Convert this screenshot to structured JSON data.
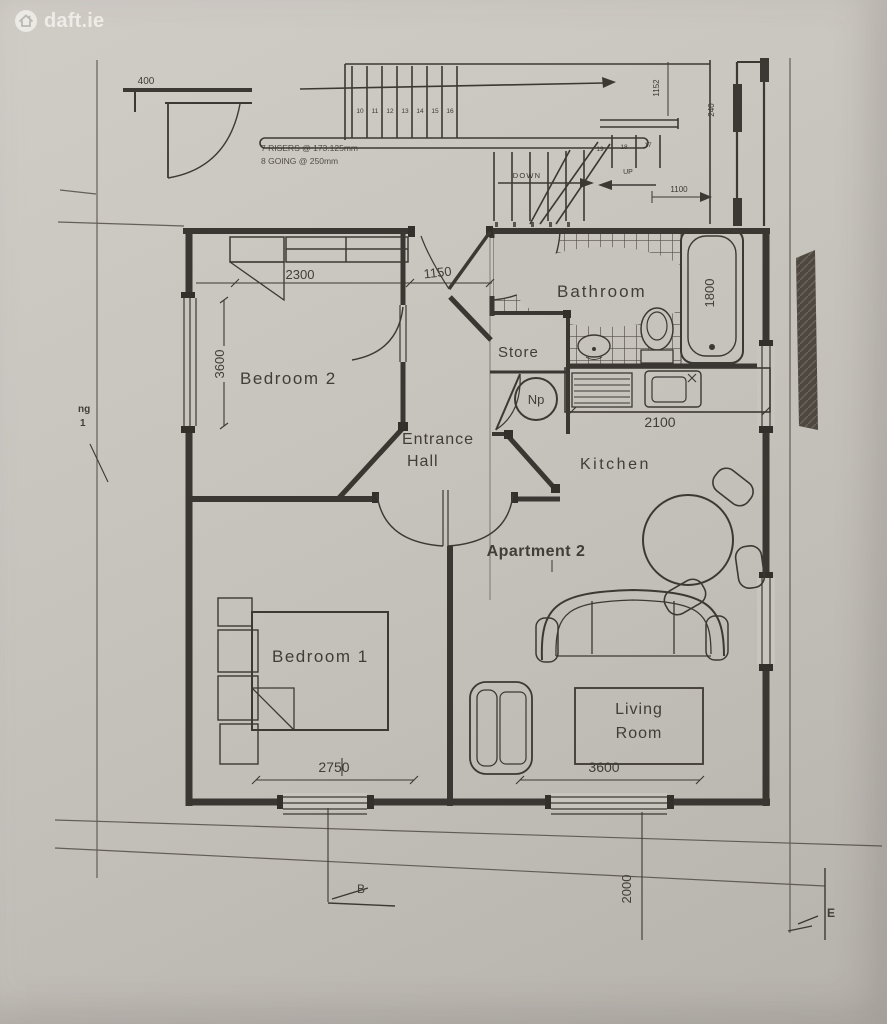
{
  "source": {
    "watermark": "daft.ie"
  },
  "plan": {
    "apartment_label": "Apartment 2",
    "rooms": {
      "bedroom2": "Bedroom 2",
      "bedroom1": "Bedroom 1",
      "entrance_line1": "Entrance",
      "entrance_line2": "Hall",
      "store": "Store",
      "bathroom": "Bathroom",
      "kitchen": "Kitchen",
      "living_line1": "Living",
      "living_line2": "Room",
      "hot_press": "Np"
    },
    "dimensions_mm": {
      "bedroom2_width": "2300",
      "hall_width": "1150",
      "bedroom2_depth": "3600",
      "bath_length": "1800",
      "kitchen_counter": "2100",
      "bedroom1_width": "2750",
      "living_width": "3600",
      "ground_offset": "2000",
      "stairwell": "1100",
      "landing": "1152",
      "wall_return": "240",
      "entry_wall": "400"
    },
    "stairs": {
      "riser_note": "7 RISERS @ 173.125mm",
      "going_note": "8 GOING @ 250mm",
      "down_label": "DOWN",
      "up_label": "UP",
      "upper_treads": [
        "10",
        "11",
        "12",
        "13",
        "14",
        "15",
        "16"
      ],
      "return_treads": [
        "19",
        "18",
        "17"
      ]
    },
    "markers": {
      "section_b": "B",
      "section_e": "E",
      "left_note_line1": "ng",
      "left_note_line2": "1"
    }
  },
  "colors": {
    "paper": "#c6c2bc",
    "ink": "#3c3833",
    "watermark": "#f4f2ee"
  }
}
